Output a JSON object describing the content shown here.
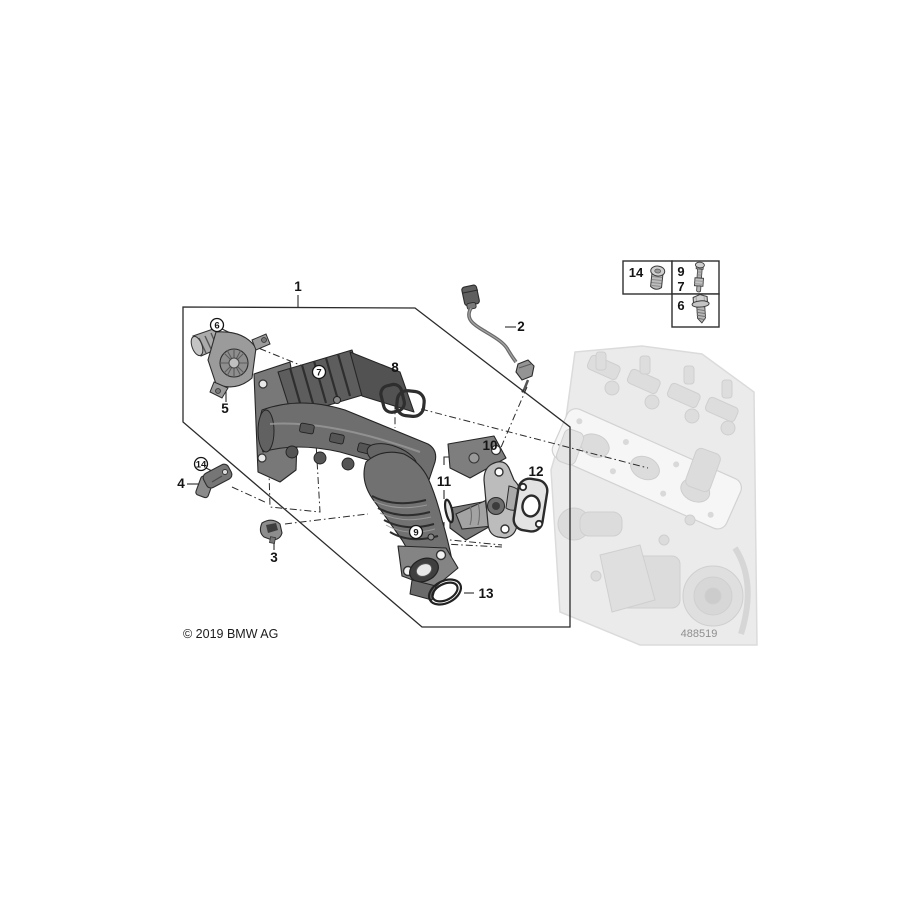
{
  "meta": {
    "copyright": "© 2019 BMW AG",
    "diagram_number": "488519"
  },
  "colors": {
    "line": "#2b2b2b",
    "part_dark": "#4a4a4a",
    "part_mid": "#6e6e6e",
    "part_light": "#bcbcbc",
    "engine_faded": "#cccccc",
    "background": "#ffffff"
  },
  "callouts": [
    {
      "label": "1",
      "circled": false
    },
    {
      "label": "2",
      "circled": false
    },
    {
      "label": "3",
      "circled": false
    },
    {
      "label": "4",
      "circled": false
    },
    {
      "label": "5",
      "circled": false
    },
    {
      "label": "6",
      "circled": true
    },
    {
      "label": "7",
      "circled": true
    },
    {
      "label": "8",
      "circled": false
    },
    {
      "label": "9",
      "circled": true
    },
    {
      "label": "10",
      "circled": false
    },
    {
      "label": "11",
      "circled": false
    },
    {
      "label": "12",
      "circled": false
    },
    {
      "label": "13",
      "circled": false
    },
    {
      "label": "14",
      "circled": true
    }
  ],
  "parts_box": {
    "cells": [
      {
        "labels": [
          "14"
        ],
        "icon": "pan-head-screw-icon"
      },
      {
        "labels": [
          "9",
          "7"
        ],
        "icon": "stud-bolt-icon"
      },
      {
        "labels": [
          "6"
        ],
        "icon": "hex-flange-screw-icon"
      }
    ]
  }
}
